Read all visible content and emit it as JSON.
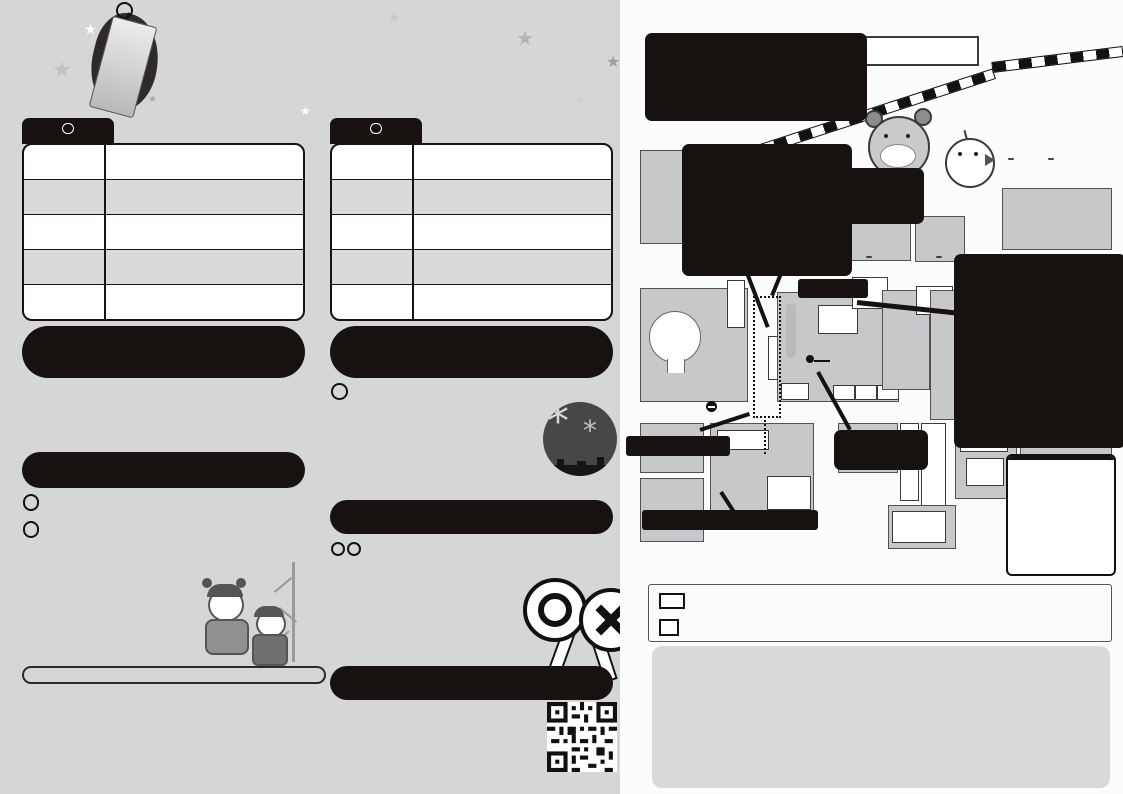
{
  "title": {
    "tag": "イベント",
    "main": "タイムスケジュール"
  },
  "sched26": {
    "date": "26日",
    "day": "土",
    "rows": [
      {
        "time": "12:30～",
        "event": "郷土芸能"
      },
      {
        "time": "14:15～",
        "event": "ダンスイベント"
      },
      {
        "time": "17:00～",
        "event": "太鼓イベント"
      },
      {
        "time": "18:30～",
        "event": "踊りの夕べ"
      },
      {
        "time": "20:45～",
        "event": "七夕まつりベストカップル"
      }
    ]
  },
  "sched27": {
    "date": "27日",
    "day": "日",
    "rows": [
      {
        "time": "12:00～",
        "event": "ダンスイベント"
      },
      {
        "time": "15:00～",
        "event": "七夕音楽フェス"
      },
      {
        "time": "18:30～",
        "event": "七夕BINGO"
      },
      {
        "time": "19:30～",
        "event": "七夕パフォーマンスショー"
      },
      {
        "time": "20:45～",
        "event_prefix": "能美市誕生20周年記念",
        "event": "打ち上げ花火"
      }
    ]
  },
  "hikari": {
    "stars": "★★★★★★",
    "subtitle": "能美市誕生20周年記念",
    "title": "光の回廊",
    "body": "全長25mの光のトンネルが会場に出現します。\n市内15保育園の年長組356名による願い事\n短冊や虹のイルミネーションで彩ります。"
  },
  "kids": {
    "stars": "★★★★★★★",
    "title": "キッズランド",
    "t1d": "26日",
    "t1w": "土",
    "t1": " 12:00～22:00",
    "t2d": "27日",
    "t2w": "日",
    "t2": " 12:00～21:00",
    "desc": "昔ながらの遊びで楽しもう！！\n景品もあるから遊びにきてね！！",
    "items": [
      "★射的",
      "★かたぬき",
      "★スマートボール",
      "★おもちゃ販売"
    ]
  },
  "notes": [
    "※ご来場の際は、帽子の着用やこまめな水分補給等、熱中症対策を行ってください。",
    "※まつり会場およびその周辺でのドローンの操縦は禁止されています。",
    "※会場では、お客様の安全と防犯のため一部エリアに防犯カメラを設置します。"
  ],
  "hanabi": {
    "stars": "★★★★★★",
    "subtitle": "能美市誕生20周年記念",
    "title": "打ち上げ花火",
    "td": "27日",
    "tw": "日",
    "time": " 20:45～21:00",
    "body": "ぜひ会場でご覧ください！\n今年は西二口町で打ち上げます。\n当日悪天候の場合は翌日28日(月)\nに順延致します。"
  },
  "quiz": {
    "stars": "★★★★",
    "title": "ゲームでクイズ大会！",
    "d1": "26日",
    "w1": "土",
    "dsep": "・",
    "d2": "27日",
    "w2": "日",
    "t": " 各日16:00～",
    "t_small": "(その他随時開催)",
    "line2": "場所：円形ホール　参加者：最大75名",
    "body": "涼しみながら楽しめる\n新たな屋内イベントです。\n1～3位の方には賞品を\n贈呈します。"
  },
  "vote": {
    "title": "踊りの夕べ一般投票",
    "line1": "能美市LINE公式アカウント",
    "line2": "事前登録はこちらから▶▶▶"
  },
  "map": {
    "title1": "能美市誕生20周年記念事業",
    "furigana": "ね あが",
    "title2": "第62回根上り七夕まつり",
    "title3": "主要会場図",
    "station": "能美根上駅",
    "kanazawa": "金沢▶",
    "komatsu": "◀小松",
    "food": {
      "header": "【飲食出店店舗】",
      "items": [
        "焼肉ハウスREED",
        "八松苑",
        "PTA.青年部OB",
        "能美市商工会女性部",
        "能美市商工会青年部",
        "ベト風味"
      ]
    },
    "kidsbox": "キッズランド\nジャンボ七夕飾り\nBINGOカード販売",
    "kitchen": {
      "header": "【キッチンカー出店店舗】",
      "items": [
        "Re:roll",
        "TI-DA (27日のみ)",
        "鯛平楽",
        "レモンヌ (27日のみ)",
        "KOMO'S KITCHEN (26日のみ)",
        "お団子カフェ (27日のみ)",
        "SINCERE～一途～",
        "アサヒ軒 (26日のみ)",
        "カチカヨ",
        "NOTO NOMAD (27日のみ)",
        "Mr.コシヒカリ (26日のみ)"
      ]
    },
    "notice": {
      "title": "お知らせ",
      "body": "打ち上げ花火会場近くでは、臨時交通規制を予定しています。詳しくは表面をご覧下さい。"
    },
    "labels": {
      "enkei": "【円形ホール】",
      "bunka": "根上総合\n文化会館",
      "churin_top": "駐輪場",
      "hikari": "光の回廊",
      "gs": "GS",
      "suika": "すいか\n売出会場",
      "ja": "JA根上",
      "taisei": "大成\n保育園",
      "ntt": "NTT",
      "keibi": "警備\n本部",
      "uketsuke": "踊り受付",
      "maru": "○",
      "jutaku": "住宅",
      "jisshi": "実施本部",
      "kaga": "加賀押し寿司研究会\n(26日のみ)",
      "concours": "踊りの夕べコンクール",
      "churin2": "駐輪場",
      "gakushu": "根上学習\nセンター",
      "planetarium": "プラネタリウム無料投影 (26日・27日)",
      "sunpalace": "サンパレー21",
      "shopping": "根上ショッピングタウン",
      "marue": "マルエー",
      "p": "P",
      "p_sub": "(駐車場)",
      "p_bunka_sub": "(文化会館\n第4駐車場)",
      "kokudo": "▼国道8号",
      "signal": "●●●",
      "arrow": "→"
    }
  },
  "legend": {
    "vehicle": "車両通行止",
    "vehicle_d1": "7月26日(土)11:00～23:00",
    "vehicle_d2": "7月27日(日)11:00～22:00",
    "parking_p": "P",
    "parking": "駐車場",
    "dots": "•••••",
    "concours": "踊りの夕べコンクール",
    "concours_d": "7月26日(土)18:30～19:25",
    "lightup": "ジャンボ七夕飾りライトアップ",
    "lightup_d": "7月22日(火)～7月27日(日)"
  },
  "history": {
    "title": "～根上り七夕まつりのおこりについて～",
    "col1": "　明治30年、織物業者が中心となり、江ノ島村商工会を結成したのが根上町商工会のはじまりです。当時の商工会事務所は織物検査所内にあり、七夕まつりの前身である「丑まつり」を実施していました。昭和40",
    "col2": "年代になると、根上町織物の祖である新田甚左衛門翁の慰霊祭として開催。その後も慰霊祭として、織物の町にちなみ、織姫七夕と関係づけて、七夕コンクール、はぎれ市などが実施されてきました。"
  }
}
